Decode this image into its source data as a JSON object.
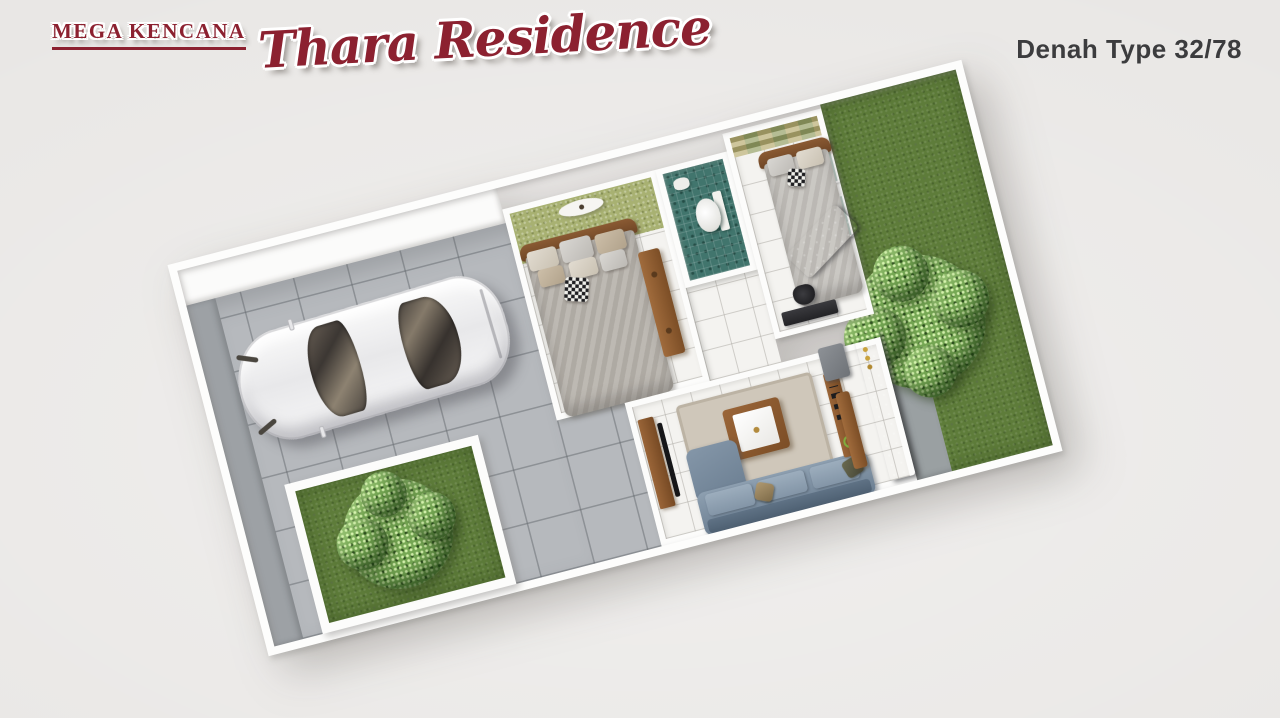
{
  "branding": {
    "company": "MEGA KENCANA",
    "project": "Thara Residence",
    "plan_title": "Denah Type 32/78"
  },
  "colors": {
    "brand_red": "#8c2130",
    "title_text": "#3c3c3e",
    "page_background": "#e9e7e5",
    "wall_white": "#fdfdfc",
    "paving": "#b6b9bd",
    "sidewalk": "#9da1a5",
    "grass": "#5e7c3a",
    "tree": "#76a854",
    "interior_floor": "#f4f3f0",
    "bedroom_accent_green": "#a8b172",
    "bedroom2_checker_olive": "#95a065",
    "bedroom2_checker_tan": "#b9ad72",
    "bathroom_teal": "#41756d",
    "sofa_blue_gray": "#8496a8",
    "wood": "#8a5a33",
    "kitchen_counter": "#35383c"
  },
  "floorplan": {
    "rotation_deg": -14.5,
    "view": "3d-top-down-render",
    "areas": [
      "carport",
      "front-lawn",
      "master-bedroom",
      "bathroom",
      "hallway",
      "second-bedroom",
      "living-room",
      "kitchen",
      "backyard"
    ]
  }
}
